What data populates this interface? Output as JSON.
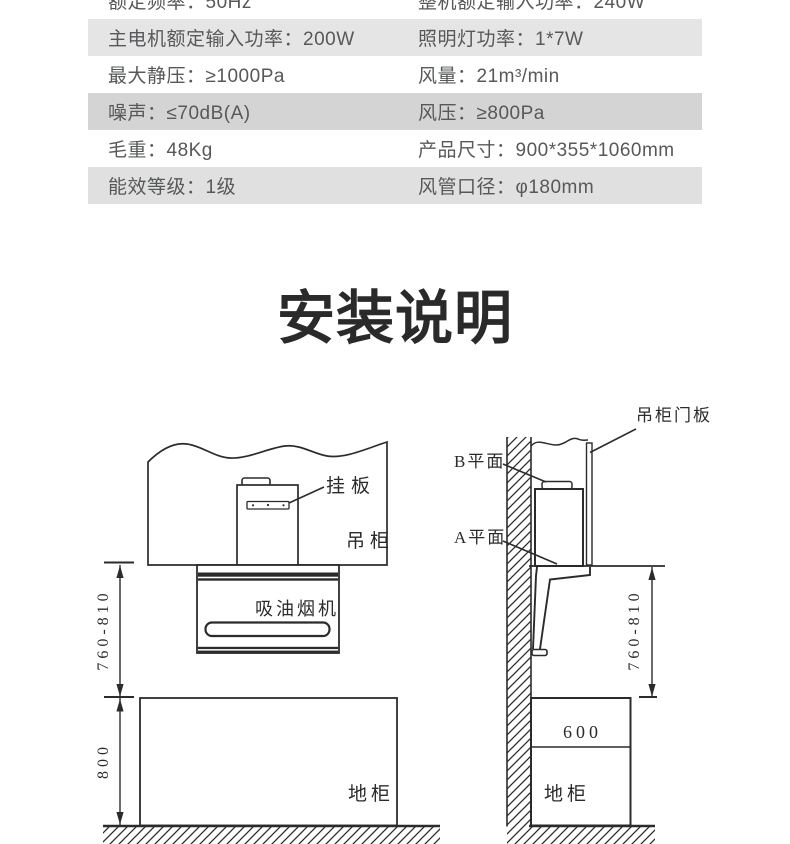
{
  "spec_table": {
    "rows": [
      {
        "col1": "额定频率：50Hz",
        "col2": "整机额定输入功率：240W"
      },
      {
        "col1": "主电机额定输入功率：200W",
        "col2": "照明灯功率：1*7W"
      },
      {
        "col1": "最大静压：≥1000Pa",
        "col2": "风量：21m³/min"
      },
      {
        "col1": "噪声：≤70dB(A)",
        "col2": "风压：≥800Pa"
      },
      {
        "col1": "毛重：48Kg",
        "col2": "产品尺寸：900*355*1060mm"
      },
      {
        "col1": "能效等级：1级",
        "col2": "风管口径：φ180mm"
      }
    ]
  },
  "section_title": "安装说明",
  "diagram": {
    "front_view": {
      "hang_plate_label": "挂板",
      "wall_cabinet_label": "吊柜",
      "hood_label": "吸油烟机",
      "floor_cabinet_label": "地柜",
      "hood_height_range_mm": "760-810",
      "counter_height_mm": "800"
    },
    "side_view": {
      "door_panel_label": "吊柜门板",
      "plane_b_label": "B平面",
      "plane_a_label": "A平面",
      "hood_height_range_mm": "760-810",
      "counter_depth_mm": "600",
      "floor_cabinet_label": "地柜"
    }
  },
  "colors": {
    "row_shade_light": "#e5e5e5",
    "row_shade_dark": "#d4d4d4",
    "row_shade_mid": "#e0e0e0",
    "table_text": "#57585a",
    "title_text": "#2a2a2a",
    "line": "#2b2b2b",
    "background": "#ffffff"
  }
}
